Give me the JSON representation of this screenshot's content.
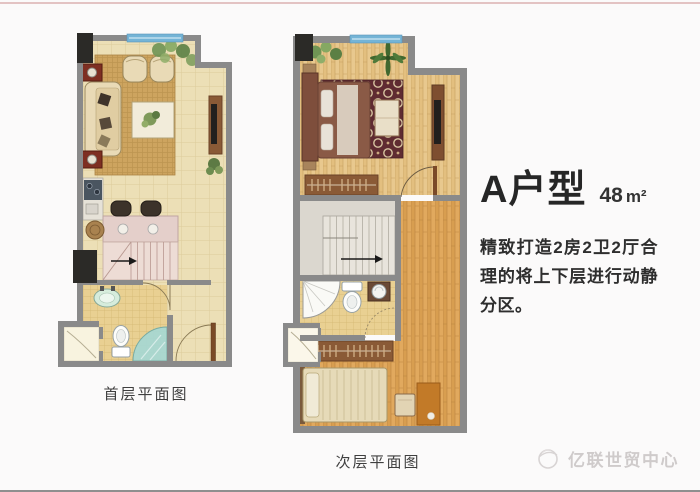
{
  "unit_info": {
    "title": "A户型",
    "area_value": "48",
    "area_unit": "m²",
    "description": "精致打造2房2卫2厅合理的将上下层进行动静分区。"
  },
  "plans": {
    "first_floor": {
      "label": "首层平面图"
    },
    "second_floor": {
      "label": "次层平面图"
    }
  },
  "watermark": {
    "text": "亿联世贸中心"
  },
  "palette": {
    "wall": "#8a8a8a",
    "wall_dark": "#2b2a27",
    "window": "#74b4d6",
    "tile_floor": "#ecdfb6",
    "bath_tile": "#e9d092",
    "wood_light": "#e8c88e",
    "wood_orange": "#e1a95e",
    "rug_tan": "#cda45f",
    "rug_maroon": "#5f2b31",
    "counter_pink": "#e4cfca",
    "shower_glass": "#a6d8d4",
    "accent_red": "#7e2f22",
    "top_line": "#e3c3c3",
    "title_text": "#262626",
    "label_text": "#3f3f3f",
    "watermark_text": "#cfcbcb"
  }
}
